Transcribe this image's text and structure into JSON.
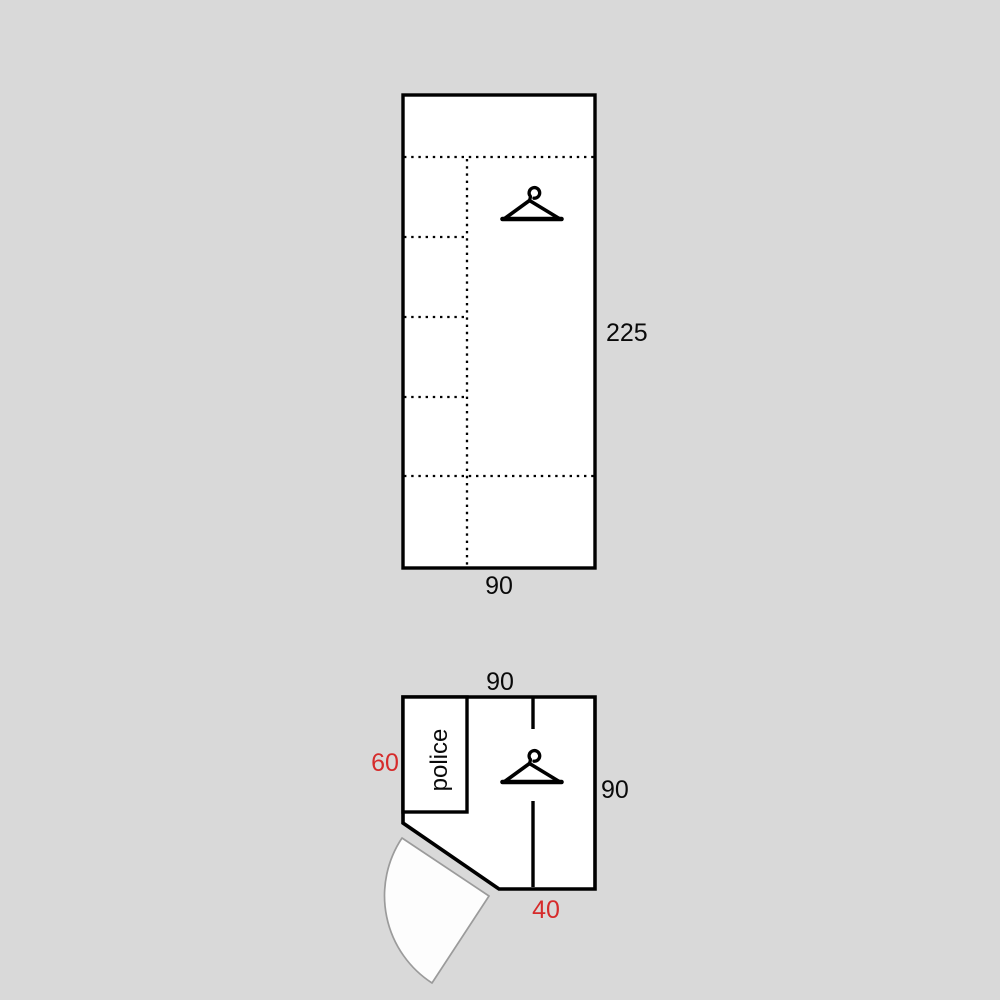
{
  "title": "wardrobe-technical-drawing",
  "colors": {
    "background": "#d9d9d9",
    "outline": "#000000",
    "surface": "#ffffff",
    "dimension_red": "#d62b2b",
    "door_arc_gray": "#9b9b9b"
  },
  "front_view": {
    "name": "front-elevation",
    "height_label": "225",
    "width_label": "90"
  },
  "plan_view": {
    "name": "top-plan",
    "top_width_label": "90",
    "right_depth_label": "90",
    "left_section_label": "60",
    "door_width_label": "40",
    "compartment_label": "police"
  },
  "icons": {
    "hanger": "hanger-icon"
  }
}
